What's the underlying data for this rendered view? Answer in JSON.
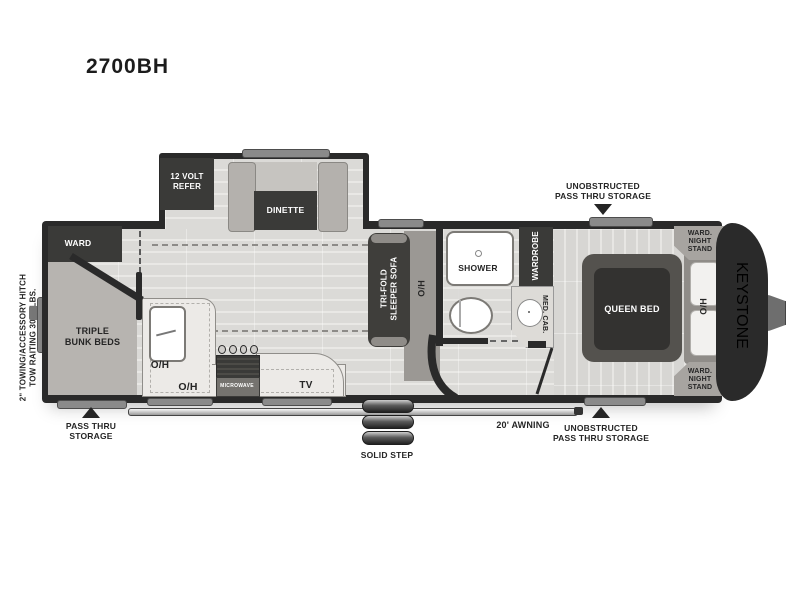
{
  "labels": {
    "title": "2700BH",
    "hitch_line1": "2\" TOWING/ACCESSORY HITCH",
    "hitch_line2": "TOW RAITING 3000 LBS.",
    "ward": "WARD",
    "bunk_line1": "TRIPLE",
    "bunk_line2": "BUNK BEDS",
    "storage_bl_line1": "PASS THRU",
    "storage_bl_line2": "STORAGE",
    "refer_line1": "12 VOLT",
    "refer_line2": "REFER",
    "dinette": "DINETTE",
    "sofa_line1": "TRI-FOLD",
    "sofa_line2": "SLEEPER SOFA",
    "oh_sofa": "O/H",
    "oh_sink": "O/H",
    "oh_counter": "O/H",
    "microwave": "MICROWAVE",
    "tv": "TV",
    "shower": "SHOWER",
    "wardrobe": "WARDROBE",
    "med_cab": "MED. CAB.",
    "queen_bed": "QUEEN BED",
    "oh_bedroom": "O/H",
    "ns_top_line1": "WARD.",
    "ns_top_line2": "NIGHT",
    "ns_top_line3": "STAND",
    "ns_bot_line1": "WARD.",
    "ns_bot_line2": "NIGHT",
    "ns_bot_line3": "STAND",
    "brand": "KEYSTONE",
    "storage_top_line1": "UNOBSTRUCTED",
    "storage_top_line2": "PASS THRU STORAGE",
    "storage_br_line1": "UNOBSTRUCTED",
    "storage_br_line2": "PASS THRU STORAGE",
    "awning": "20'  AWNING",
    "solid_step": "SOLID STEP"
  },
  "colors": {
    "wall": "#2a2a2a",
    "floor_light": "#e2e1de",
    "furniture_gray": "#b4b1ad",
    "dark_fixture": "#3a3a38",
    "white_fixture": "#ffffff",
    "label_text": "#252525"
  }
}
